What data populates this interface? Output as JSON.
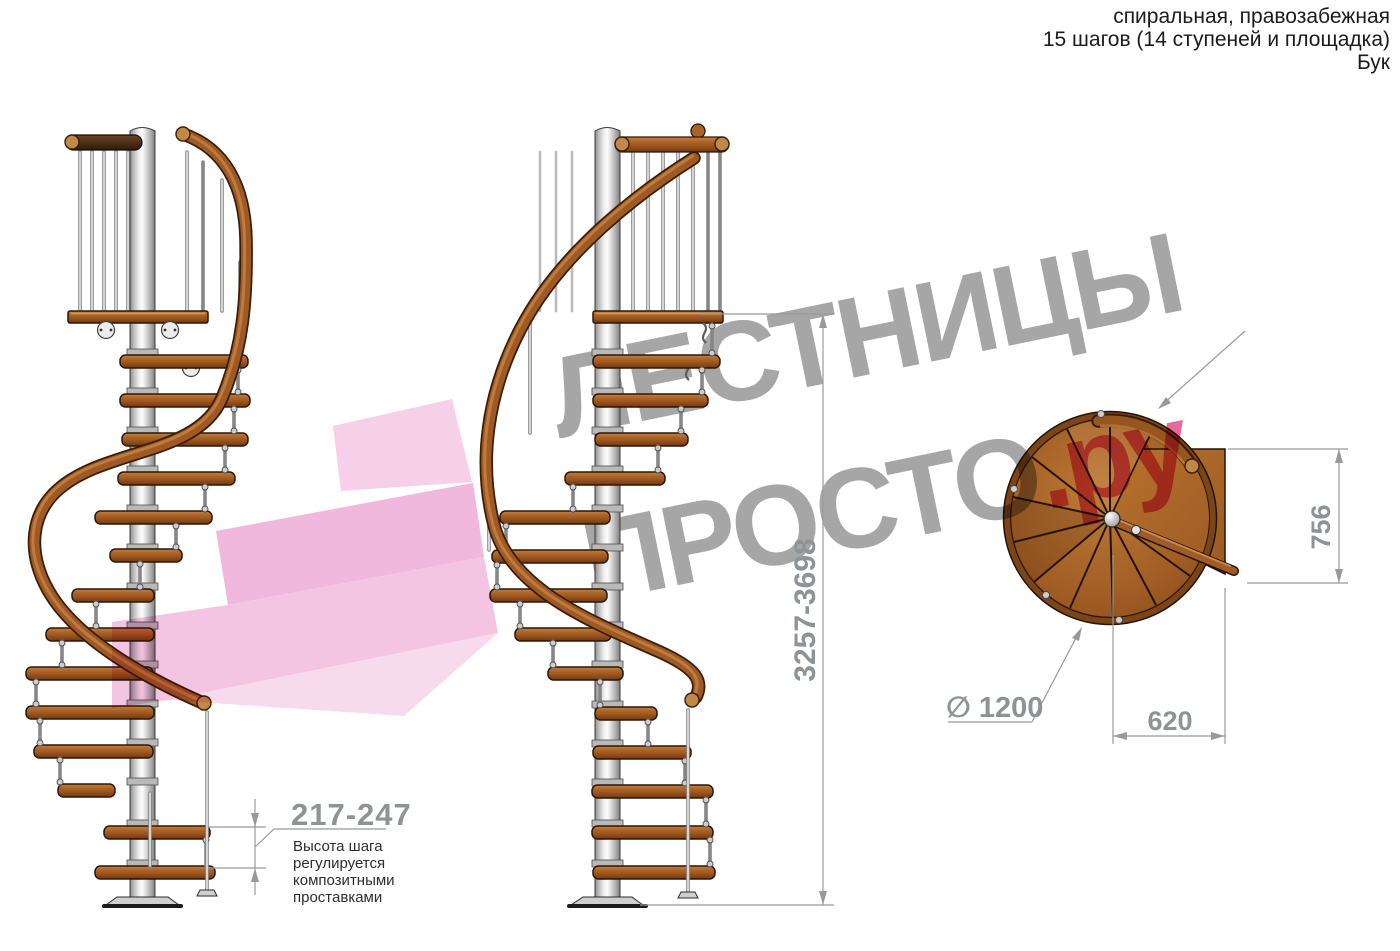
{
  "header": {
    "lines": [
      "спиральная, правозабежная",
      "15 шагов (14 ступеней и площадка)",
      "Бук"
    ]
  },
  "watermark": {
    "line1": "ЛЕСТНИЦЫ",
    "line2": "ПРОСТО",
    "suffix": ".ру"
  },
  "annotations": {
    "total_height": "3257-3698",
    "step_height": "217-247",
    "step_height_note": "Высота шага\nрегулируется\nкомпозитными\nпроставками",
    "landing_depth": "756",
    "landing_width": "620",
    "diameter": "∅ 1200"
  },
  "colors": {
    "dimension_gray": "#8f9396",
    "note_text": "#2e2e2e",
    "watermark_gray": "#a6a6a6",
    "watermark_pink": "#e8679c",
    "arrow_pink": "#f0b2da",
    "wood_brown": "#9e5a26",
    "pole_silver": "#d9d9d9"
  }
}
